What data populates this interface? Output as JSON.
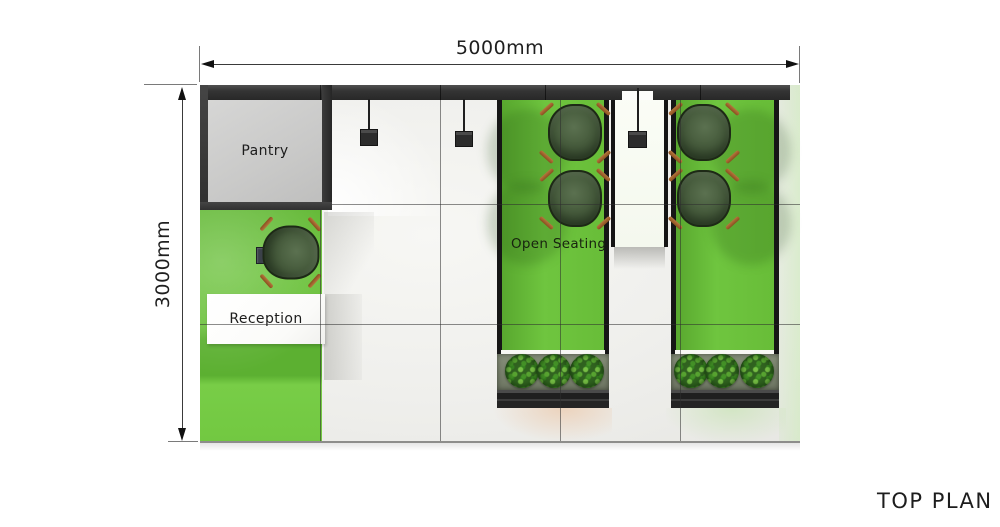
{
  "title": {
    "label": "TOP PLAN"
  },
  "dimensions": {
    "width_label": "5000mm",
    "height_label": "3000mm"
  },
  "rooms": {
    "pantry": {
      "label": "Pantry"
    },
    "reception": {
      "label": "Reception"
    },
    "open_seating": {
      "label": "Open Seating"
    }
  },
  "objects": {
    "pendant_lights": 3,
    "chairs": 5,
    "planters": 2,
    "bushes_per_planter": 3
  },
  "colors": {
    "accent_green": "#6CC13E",
    "dark_wall": "#333333",
    "pantry_floor": "#CBCBCB",
    "main_floor": "#F0F0ED",
    "chair_seat": "#46593C",
    "chair_leg": "#A05E28",
    "planter_base": "#262626",
    "bush_green": "#37701F",
    "desk_white": "#FFFFFF",
    "annotation_text": "#1F1F1F"
  }
}
